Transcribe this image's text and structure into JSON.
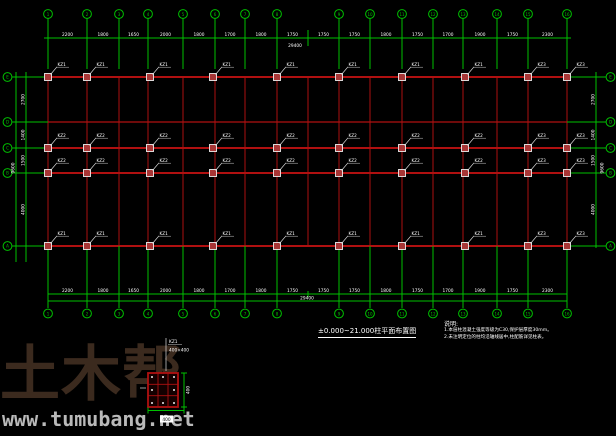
{
  "drawing": {
    "title": "±0.000~21.000柱平面布置图",
    "notes": {
      "header": "说明:",
      "items": [
        "1.本层柱混凝土强度等级为C30,保护层厚度30mm。",
        "2.未注明定位的柱均沿轴线居中,柱配筋详见柱表。"
      ]
    },
    "watermark": {
      "brand": "土木帮",
      "url": "www.tumubang.net"
    },
    "top_overall": "29400",
    "bottom_overall": "29400",
    "side_overall": "9600",
    "axes": {
      "x_bubbled": [
        48,
        87,
        119,
        148,
        183,
        215,
        245,
        277,
        339,
        370,
        402,
        433,
        463,
        497,
        528,
        567
      ],
      "x_tick_only": [
        308
      ],
      "x_labels": [
        "1",
        "2",
        "3",
        "4",
        "5",
        "6",
        "7",
        "8",
        "9",
        "10",
        "11",
        "12",
        "13",
        "14",
        "15",
        "16"
      ],
      "y": [
        77,
        122,
        148,
        173,
        246
      ],
      "y_labels": [
        "E",
        "D",
        "C",
        "B",
        "A"
      ]
    },
    "dims": {
      "top": [
        "2200",
        "1800",
        "1650",
        "2000",
        "1800",
        "1700",
        "1800",
        "1750",
        "1750",
        "1750",
        "1800",
        "1750",
        "1700",
        "1900",
        "1750",
        "2300"
      ],
      "bottom": [
        "2200",
        "1800",
        "1650",
        "2000",
        "1800",
        "1700",
        "1800",
        "1750",
        "1750",
        "1750",
        "1800",
        "1750",
        "1700",
        "1900",
        "1750",
        "2300"
      ],
      "left": [
        "2700",
        "1400",
        "1500",
        "4000"
      ],
      "right": [
        "2700",
        "1400",
        "1500",
        "4000"
      ]
    },
    "columns": {
      "x": [
        48,
        87,
        150,
        213,
        277,
        339,
        402,
        465,
        528,
        567
      ],
      "rows": [
        {
          "y": 77,
          "label": "KZ1"
        },
        {
          "y": 148,
          "label": "KZ2"
        },
        {
          "y": 173,
          "label": "KZ2"
        },
        {
          "y": 246,
          "label": "KZ1"
        }
      ],
      "end_label": "KZ3",
      "end_label_from": 528
    },
    "detail": {
      "tag": "KZ1",
      "spec": "400×400",
      "dim_w": "400",
      "dim_h": "400"
    },
    "colors": {
      "green": "#00c000",
      "red": "#b01010",
      "dark_red": "#7a0c0c",
      "white": "#ffffff",
      "col_fill": "#a83636",
      "leader": "#dddddd",
      "brand": "#3b2a1e",
      "url_gray": "#b9b9b9"
    }
  }
}
